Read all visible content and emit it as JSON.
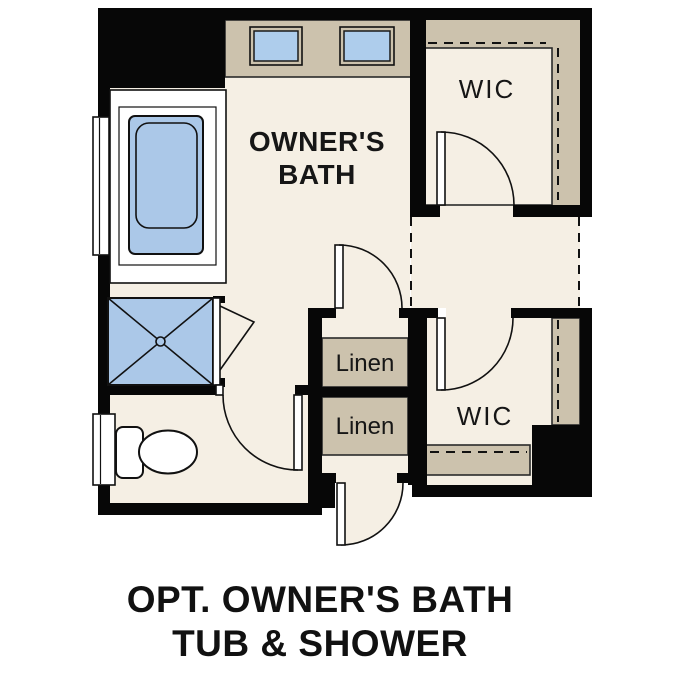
{
  "plan": {
    "rooms": {
      "owners_bath": {
        "line1": "OWNER'S",
        "line2": "BATH"
      },
      "wic_top": {
        "label": "WIC"
      },
      "wic_bottom": {
        "label": "WIC"
      },
      "linen_top": {
        "label": "Linen"
      },
      "linen_bottom": {
        "label": "Linen"
      }
    },
    "fixtures": {
      "tub": "bathtub",
      "shower": "shower-pan",
      "toilet": "toilet",
      "sinks": [
        "vanity-sink",
        "vanity-sink"
      ]
    },
    "colors": {
      "background": "#ffffff",
      "wall": "#070707",
      "floor_cream": "#f5efe4",
      "cabinet_tan": "#ccc2ad",
      "fixture_blue": "#abc8e8",
      "sink_blue": "#aecdec",
      "line": "#111111",
      "text": "#161616"
    }
  },
  "caption": {
    "line1": "OPT. OWNER'S BATH",
    "line2": "TUB & SHOWER"
  }
}
